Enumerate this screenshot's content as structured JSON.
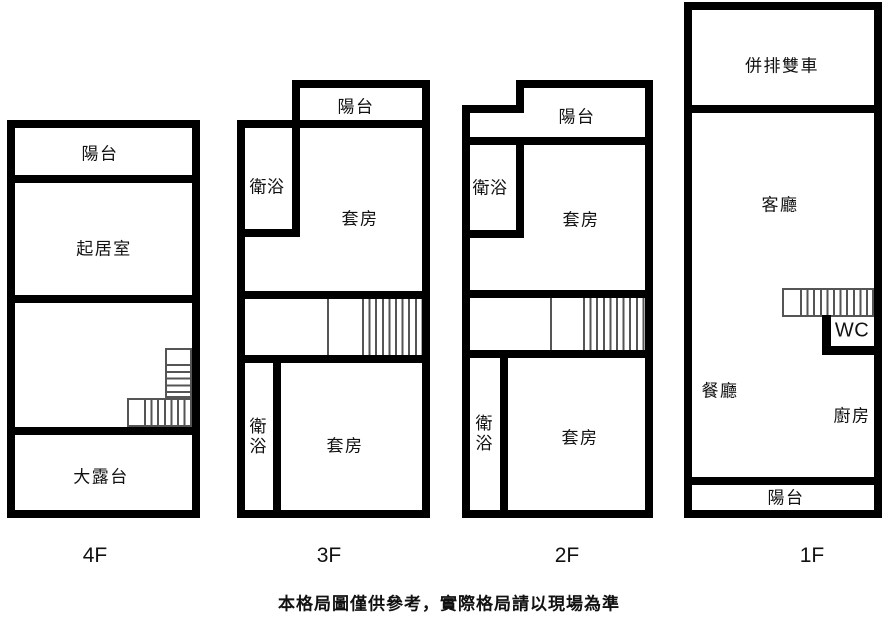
{
  "floors": [
    {
      "id": "4f",
      "label": "4F",
      "rooms": {
        "balcony": "陽台",
        "living": "起居室",
        "terrace": "大露台"
      }
    },
    {
      "id": "3f",
      "label": "3F",
      "rooms": {
        "balcony": "陽台",
        "bath_top": "衛浴",
        "suite_top": "套房",
        "bath_bottom": "衛浴",
        "suite_bottom": "套房"
      }
    },
    {
      "id": "2f",
      "label": "2F",
      "rooms": {
        "balcony": "陽台",
        "bath_top": "衛浴",
        "suite_top": "套房",
        "bath_bottom": "衛浴",
        "suite_bottom": "套房"
      }
    },
    {
      "id": "1f",
      "label": "1F",
      "rooms": {
        "garage": "併排雙車",
        "living": "客廳",
        "wc": "WC",
        "dining": "餐廳",
        "kitchen": "廚房",
        "balcony": "陽台"
      }
    }
  ],
  "footer": {
    "disclaimer": "本格局圖僅供參考，實際格局請以現場為準"
  },
  "colors": {
    "wall": "#000000",
    "background": "#ffffff",
    "stair_line": "#555555"
  }
}
